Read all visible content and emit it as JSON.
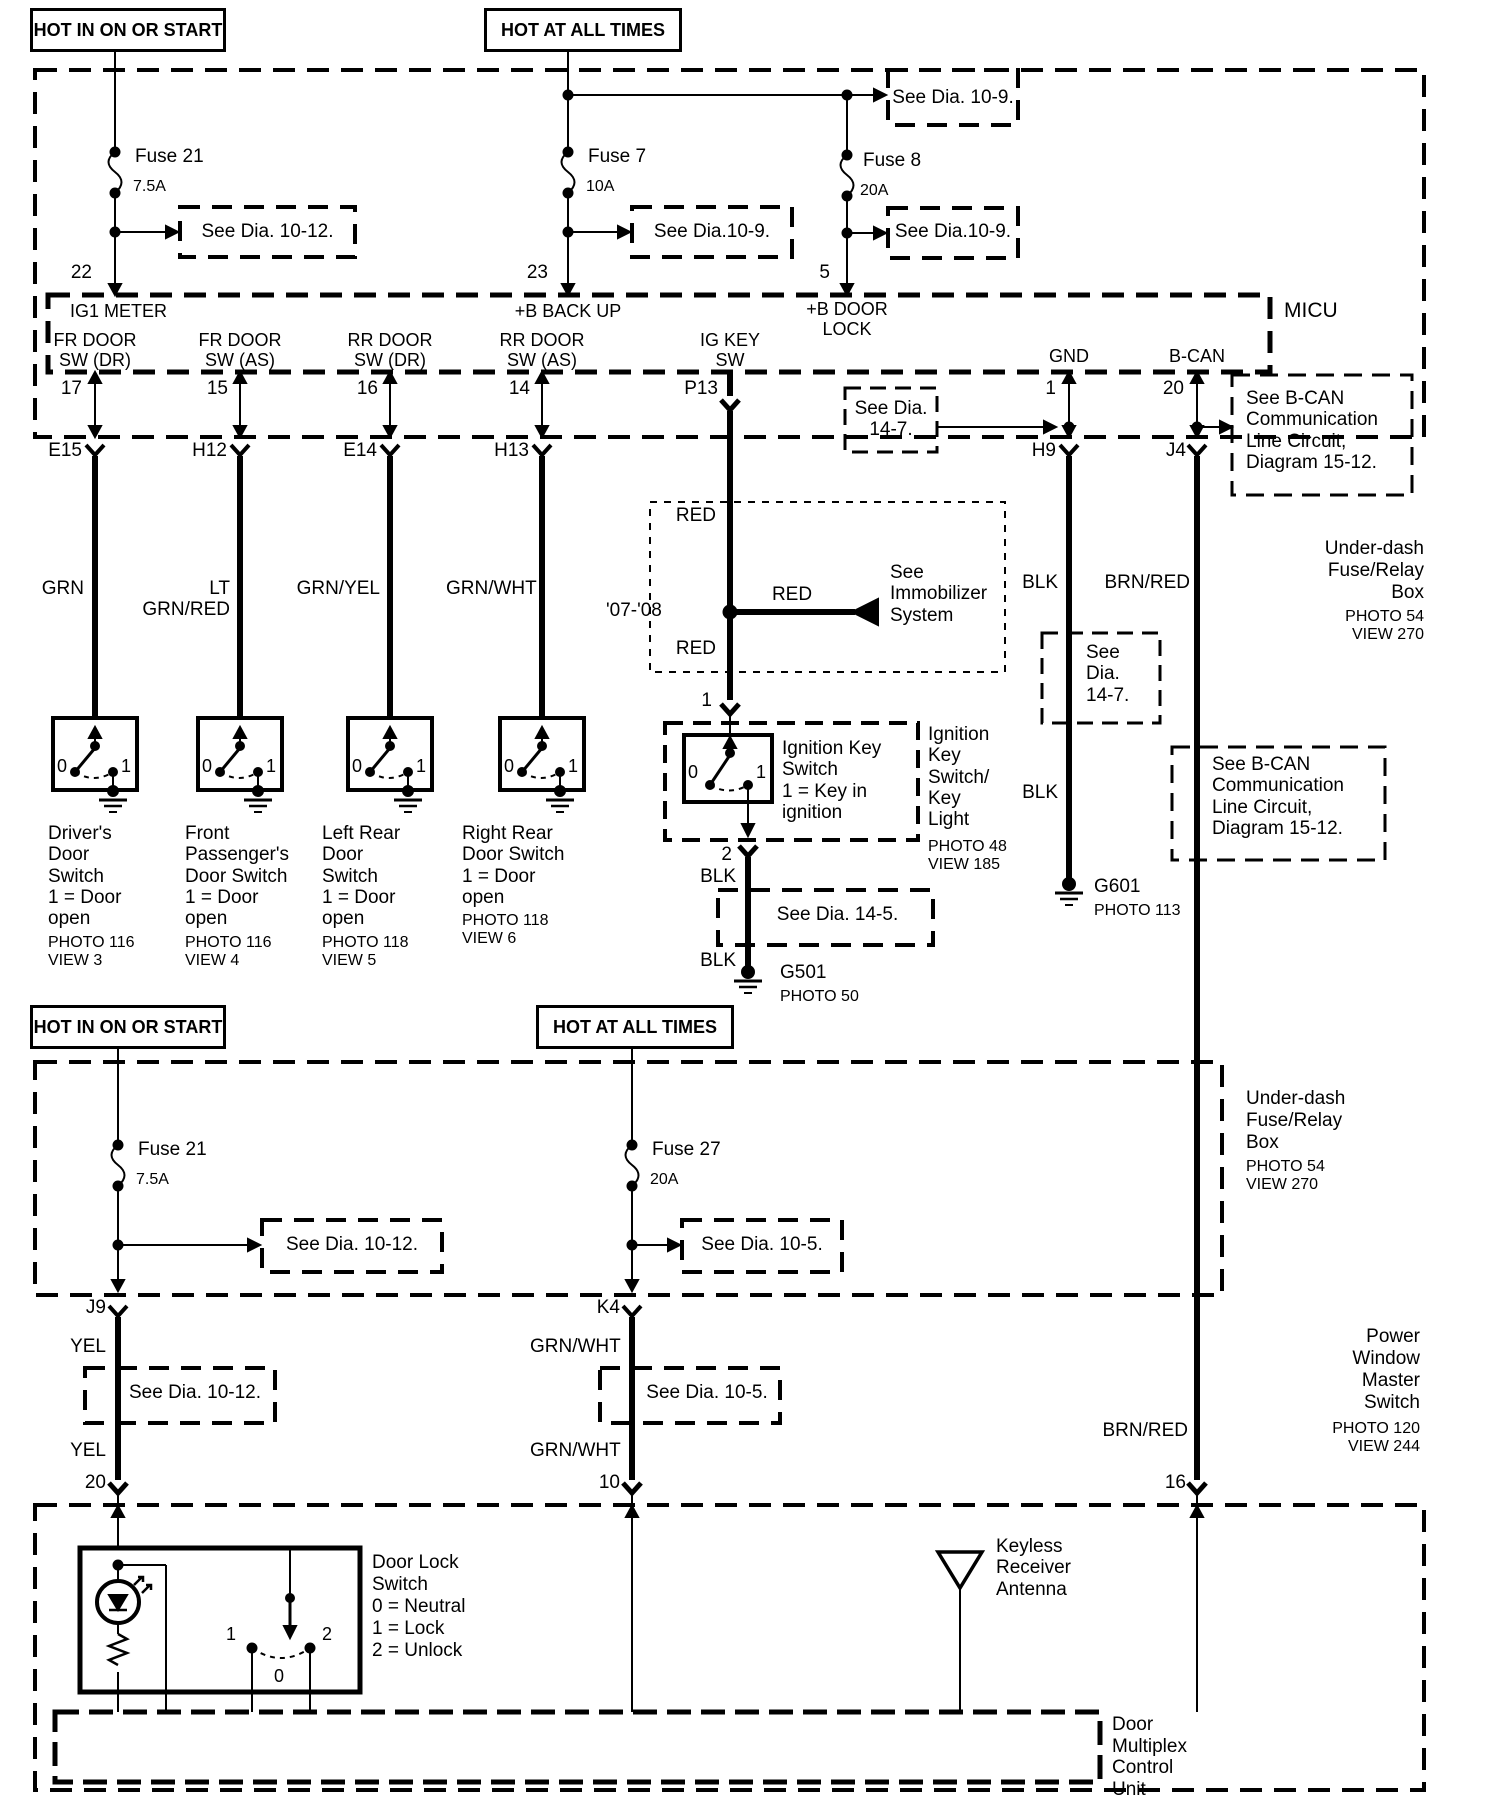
{
  "ink": "#000000",
  "bg": "#ffffff",
  "top": {
    "hot_on_start": "HOT IN ON OR START",
    "hot_all_times": "HOT AT ALL TIMES",
    "fuse21": "Fuse 21",
    "fuse21_amps": "7.5A",
    "fuse7": "Fuse 7",
    "fuse7_amps": "10A",
    "fuse8": "Fuse 8",
    "fuse8_amps": "20A",
    "see_dia_10_12": "See Dia. 10-12.",
    "see_dia_10_9_mid": "See Dia.10-9.",
    "see_dia_10_9_top": "See Dia. 10-9.",
    "see_dia_10_9_fuse8": "See Dia.10-9.",
    "pin22": "22",
    "pin23": "23",
    "pin5": "5",
    "micu": "MICU",
    "ig1_meter": "IG1 METER",
    "b_backup": "+B BACK UP",
    "b_doorlock": "+B DOOR\nLOCK",
    "fr_door_dr": "FR DOOR\nSW (DR)",
    "fr_door_as": "FR DOOR\nSW (AS)",
    "rr_door_dr": "RR DOOR\nSW (DR)",
    "rr_door_as": "RR DOOR\nSW (AS)",
    "ig_key_sw": "IG KEY\nSW",
    "gnd": "GND",
    "b_can": "B-CAN",
    "pin17": "17",
    "pin15": "15",
    "pin16": "16",
    "pin14": "14",
    "pin_p13": "P13",
    "pin1": "1",
    "pin20": "20",
    "see_dia_14_7": "See Dia.\n14-7.",
    "see_bcan_1": "See B-CAN\nCommunication\nLine Circuit,\nDiagram 15-12."
  },
  "mid": {
    "e15": "E15",
    "h12": "H12",
    "e14": "E14",
    "h13": "H13",
    "h9": "H9",
    "j4": "J4",
    "underdash": "Under-dash\nFuse/Relay\nBox",
    "underdash_photo": "PHOTO 54\nVIEW 270",
    "grn": "GRN",
    "lt_grn_red": "LT GRN/RED",
    "grn_yel": "GRN/YEL",
    "grn_wht": "GRN/WHT",
    "red_upper": "RED",
    "red_lower": "RED",
    "red_h": "RED",
    "year": "'07-'08",
    "see_immobilizer": "See\nImmobilizer\nSystem",
    "blk_h9_upper": "BLK",
    "blk_h9_lower": "BLK",
    "brn_red": "BRN/RED",
    "ign_pin1": "1",
    "ign_pin2": "2",
    "ignition_inline": "Ignition Key\nSwitch\n1 = Key in\n      ignition",
    "ignition_side": "Ignition\nKey\nSwitch/\nKey\nLight",
    "ignition_photo": "PHOTO 48\nVIEW 185",
    "blk_ign_upper": "BLK",
    "blk_ign_lower": "BLK",
    "see_dia_14_5": "See Dia. 14-5.",
    "g501": "G501",
    "g501_photo": "PHOTO 50",
    "see_dia_14_7b": "See\nDia.\n14-7.",
    "g601": "G601",
    "g601_photo": "PHOTO 113",
    "see_bcan_2": "See B-CAN\nCommunication\nLine Circuit,\nDiagram 15-12.",
    "sw0": "0",
    "sw1": "1",
    "door_switches": [
      {
        "label": "Driver's\nDoor\nSwitch\n1 = Door\n      open",
        "photo": "PHOTO 116\nVIEW 3"
      },
      {
        "label": "Front\nPassenger's\nDoor Switch\n1 = Door\n      open",
        "photo": "PHOTO 116\nVIEW 4"
      },
      {
        "label": "Left Rear\nDoor\nSwitch\n1 = Door\n      open",
        "photo": "PHOTO 118\nVIEW 5"
      },
      {
        "label": "Right Rear\nDoor Switch\n1 = Door\n      open",
        "photo": "PHOTO 118\nVIEW 6"
      }
    ]
  },
  "sec2": {
    "hot_on_start": "HOT IN ON OR START",
    "hot_all_times": "HOT AT ALL TIMES",
    "fuse21": "Fuse 21",
    "fuse21_amps": "7.5A",
    "fuse27": "Fuse 27",
    "fuse27_amps": "20A",
    "see_dia_10_12_a": "See Dia. 10-12.",
    "see_dia_10_5_a": "See Dia. 10-5.",
    "underdash": "Under-dash\nFuse/Relay\nBox",
    "underdash_photo": "PHOTO 54\nVIEW 270",
    "j9": "J9",
    "k4": "K4",
    "yel_upper": "YEL",
    "yel_lower": "YEL",
    "grnwht_upper": "GRN/WHT",
    "grnwht_lower": "GRN/WHT",
    "see_dia_10_12_b": "See Dia. 10-12.",
    "see_dia_10_5_b": "See Dia. 10-5.",
    "pin20": "20",
    "pin10": "10",
    "pin16": "16",
    "brn_red": "BRN/RED",
    "pw_master": "Power\nWindow\nMaster\nSwitch",
    "pw_photo": "PHOTO 120\nVIEW 244"
  },
  "bottom": {
    "door_lock_label": "Door Lock\nSwitch\n0 = Neutral\n1 = Lock\n2 = Unlock",
    "dls_1": "1",
    "dls_2": "2",
    "dls_0": "0",
    "keyless": "Keyless\nReceiver\nAntenna",
    "dmcu": "Door\nMultiplex\nControl\nUnit"
  }
}
